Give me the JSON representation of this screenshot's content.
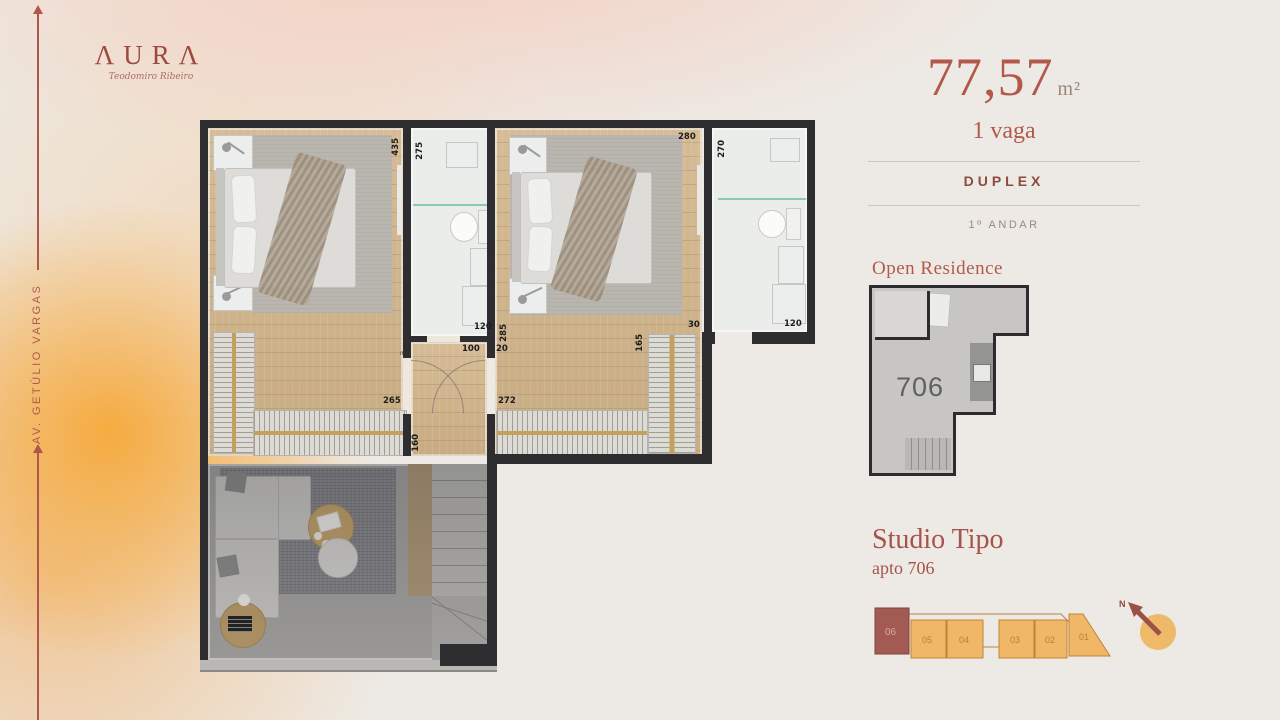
{
  "logo": {
    "brand": "AURA",
    "brand_display": "ΛURΛ",
    "signature": "Teodomiro Ribeiro"
  },
  "road": {
    "label": "AV. GETÚLIO VARGAS"
  },
  "info": {
    "area_value": "77,57",
    "area_unit": "m²",
    "parking": "1 vaga",
    "type": "DUPLEX",
    "floor": "1º ANDAR",
    "residence_title": "Open Residence",
    "unit_number": "706",
    "studio_title": "Studio Tipo",
    "studio_subtitle": "apto 706"
  },
  "plan": {
    "dims": {
      "bed1_height": "435",
      "bath1_depth": "275",
      "bed2_width": "280",
      "bath2_depth": "270",
      "bath1_width": "120",
      "hall_a": "100",
      "hall_b": "20",
      "bed2_left": "285",
      "bed2_gap": "30",
      "wardrobe2_height": "165",
      "bath2_width": "120",
      "wardrobe1_width": "265",
      "wardrobe2_width": "272",
      "stair_width": "160",
      "door_marker": "m"
    }
  },
  "keyplan": {
    "units": [
      "06",
      "05",
      "04",
      "03",
      "02",
      "01"
    ],
    "north": "N"
  },
  "colors": {
    "accent": "#b2594a",
    "dark_red": "#8e4a3f",
    "orange": "#efb766",
    "unit_highlight": "#a25a53",
    "wall": "#2e2e30",
    "wood": "#cfb38c",
    "glow": "#f6a631"
  }
}
